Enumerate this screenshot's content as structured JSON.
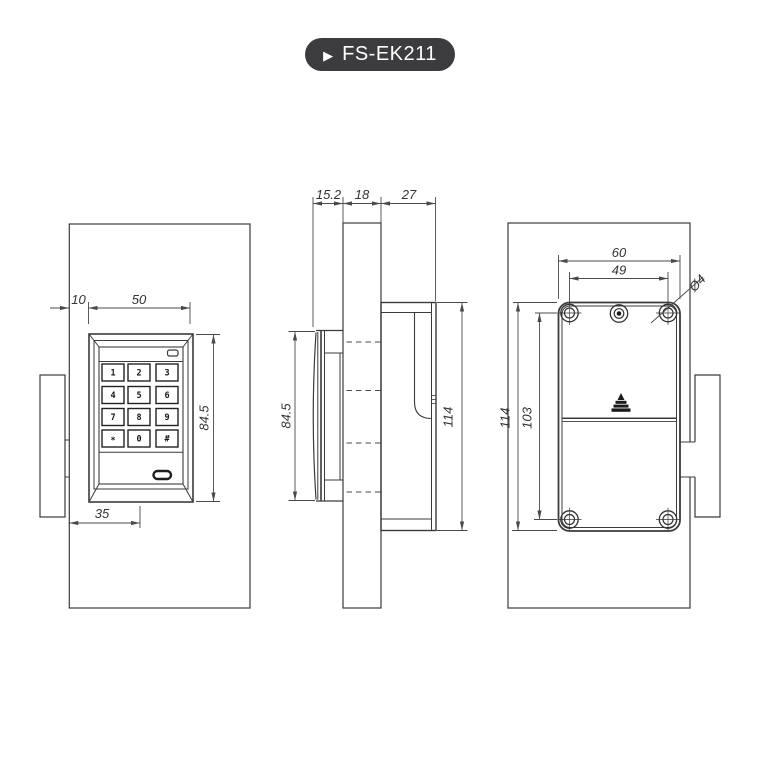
{
  "badge": {
    "icon": "▶",
    "label": "FS-EK211"
  },
  "front_view": {
    "dims": {
      "edge_offset": "10",
      "keypad_width": "50",
      "keypad_height": "84.5",
      "center_offset": "35"
    },
    "keypad_keys": [
      "1",
      "2",
      "3",
      "4",
      "5",
      "6",
      "7",
      "8",
      "9",
      "*",
      "0",
      "#"
    ]
  },
  "side_view": {
    "dims": {
      "keypad_depth": "15.2",
      "door_thickness": "18",
      "lock_depth": "27",
      "keypad_height": "84.5",
      "lock_height": "114"
    }
  },
  "back_view": {
    "dims": {
      "lock_width": "60",
      "screw_span_width": "49",
      "screw_diameter": "Ø4",
      "lock_height": "114",
      "screw_span_height": "103"
    }
  }
}
